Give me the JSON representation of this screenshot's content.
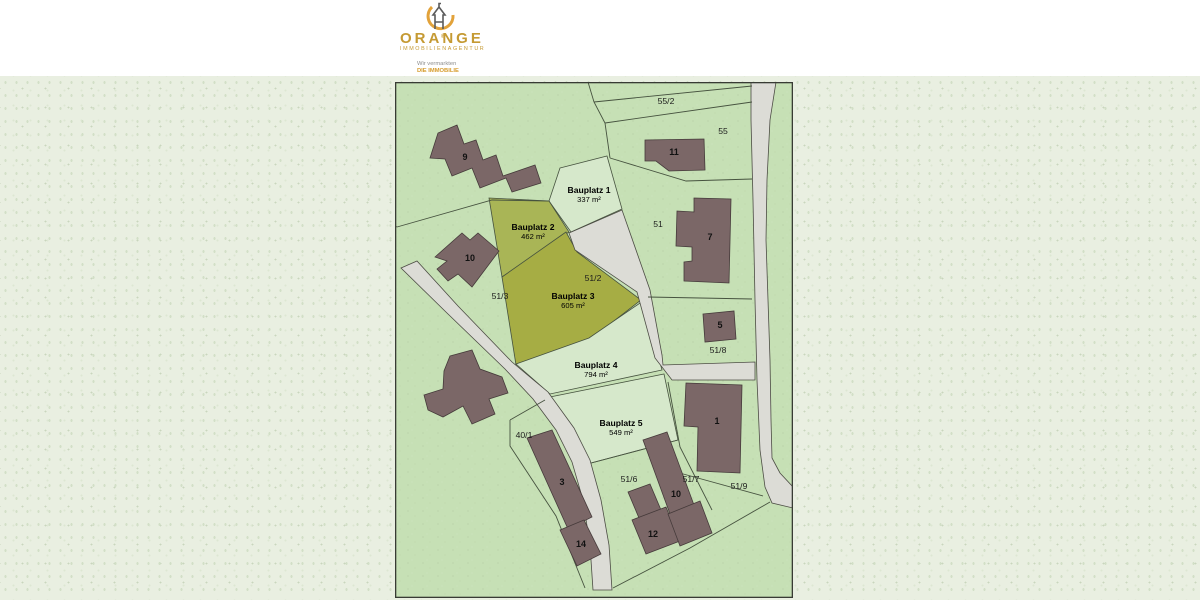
{
  "logo": {
    "brand": "ORANGE",
    "registered": "®",
    "subtitle": "IMMOBILIENAGENTUR",
    "tagline_line1": "Wir vermarkten",
    "tagline_line2": "DIE IMMOBILIE",
    "brand_color": "#c59a33",
    "swoosh_color": "#e2a23a"
  },
  "map": {
    "colors": {
      "base_green": "#c6e0b5",
      "plot_green": "#d6e8cb",
      "olive_plot2": "#a9b556",
      "olive_plot3": "#a6ad44",
      "road_fill": "#dcdcd6",
      "road_stroke": "#4c4c44",
      "line_stroke": "#46523f",
      "building_fill": "#7b6767",
      "building_stroke": "#453a3a",
      "border": "#383b34"
    },
    "frame": {
      "x": 395,
      "y": 82,
      "w": 398,
      "h": 516
    },
    "plots": [
      {
        "name": "parcel-bauplatz-1",
        "fill": "plot_green",
        "points": "560,168 607,156 622,209 571,232 549,201"
      },
      {
        "name": "parcel-bauplatz-2",
        "fill": "olive_plot2",
        "points": "489,198 549,201 569,232 502,277"
      },
      {
        "name": "parcel-bauplatz-3",
        "fill": "olive_plot3",
        "points": "502,277 566,232 577,252 641,300 588,341 516,365"
      },
      {
        "name": "parcel-bauplatz-4",
        "fill": "plot_green",
        "points": "516,364 589,338 643,301 662,370 550,394"
      },
      {
        "name": "parcel-bauplatz-5",
        "fill": "plot_green",
        "points": "545,398 664,374 678,440 591,463"
      }
    ],
    "roads": [
      {
        "name": "road-right",
        "points": "751,82 776,82 770,120 767,180 766,240 768,300 770,360 771,420 772,458 780,473 793,487 793,508 772,503 765,487 760,450 757,380 755,300 753,200 751,120"
      },
      {
        "name": "road-left",
        "points": "401,268 417,261 458,306 512,362 548,392 574,428 590,460 601,500 609,545 612,590 593,590 590,545 583,500 572,462 556,430 533,399 505,369 448,314"
      },
      {
        "name": "access-path",
        "points": "569,233 622,210 650,290 662,355 663,365 755,362 755,380 672,380 655,358 637,292 575,250"
      }
    ],
    "boundary_lines": [
      {
        "name": "line-outside-tick",
        "points": "384,221 397,227"
      },
      {
        "name": "line-parcel9-south",
        "points": "397,227 492,200 549,201"
      },
      {
        "name": "line-55-west",
        "points": "588,82 594,102 605,123 610,158"
      },
      {
        "name": "line-55-2-north",
        "points": "594,102 752,86"
      },
      {
        "name": "line-55-2-south",
        "points": "605,123 752,102"
      },
      {
        "name": "line-55-south",
        "points": "610,158 686,181 752,179"
      },
      {
        "name": "line-51-8-north",
        "points": "648,297 752,299"
      },
      {
        "name": "line-parcel1-west",
        "points": "668,382 680,447 712,510"
      },
      {
        "name": "line-51-9-south",
        "points": "676,472 763,496"
      },
      {
        "name": "line-bottom-long",
        "points": "613,588 690,548 770,502"
      },
      {
        "name": "line-bauplatz5-south",
        "points": "591,463 678,440"
      },
      {
        "name": "line-40-1-east",
        "points": "510,420 510,446 556,516 585,588"
      },
      {
        "name": "line-40-1-north",
        "points": "510,420 545,400"
      }
    ],
    "buildings": [
      {
        "name": "building-9",
        "label": "9",
        "lx": 465,
        "ly": 160,
        "points": "430,158 438,133 457,125 464,144 476,140 483,160 496,155 503,176 535,165 541,183 512,192 506,178 480,188 472,168 452,176 445,159"
      },
      {
        "name": "building-10",
        "label": "10",
        "lx": 470,
        "ly": 261,
        "points": "435,257 462,233 470,240 478,233 499,251 472,287 458,274 448,281 437,269 447,261"
      },
      {
        "name": "building-11",
        "label": "11",
        "lx": 674,
        "ly": 155,
        "points": "645,140 704,139 705,170 669,171 656,161 645,161"
      },
      {
        "name": "building-7",
        "label": "7",
        "lx": 710,
        "ly": 240,
        "points": "694,198 731,199 729,283 684,281 684,262 692,261 692,247 676,246 677,211 694,212"
      },
      {
        "name": "building-5",
        "label": "5",
        "lx": 720,
        "ly": 328,
        "points": "703,314 734,311 736,339 705,342"
      },
      {
        "name": "farm-building",
        "label": "",
        "lx": 0,
        "ly": 0,
        "points": "450,356 472,350 480,369 502,377 508,393 489,399 495,414 472,424 463,406 443,417 428,410 424,395 443,389 444,371"
      },
      {
        "name": "building-1",
        "label": "1",
        "lx": 717,
        "ly": 424,
        "points": "686,383 742,385 740,473 697,471 698,427 684,426"
      },
      {
        "name": "building-3",
        "label": "3",
        "lx": 562,
        "ly": 485,
        "points": "527,438 552,430 592,517 568,529"
      },
      {
        "name": "building-14",
        "label": "14",
        "lx": 581,
        "ly": 547,
        "points": "560,530 584,520 601,554 577,566"
      },
      {
        "name": "building-12a",
        "label": "",
        "lx": 0,
        "ly": 0,
        "points": "628,492 650,484 661,510 639,518"
      },
      {
        "name": "building-12",
        "label": "12",
        "lx": 653,
        "ly": 537,
        "points": "632,520 666,507 680,541 646,554"
      },
      {
        "name": "building-10b",
        "label": "10",
        "lx": 676,
        "ly": 497,
        "points": "643,440 667,432 694,505 670,514"
      },
      {
        "name": "building-10c",
        "label": "",
        "lx": 0,
        "ly": 0,
        "points": "668,514 700,501 712,533 680,546"
      }
    ],
    "parcel_labels": [
      {
        "text": "55/2",
        "x": 666,
        "y": 104
      },
      {
        "text": "55",
        "x": 723,
        "y": 134
      },
      {
        "text": "51",
        "x": 658,
        "y": 227
      },
      {
        "text": "51/3",
        "x": 500,
        "y": 299
      },
      {
        "text": "51/2",
        "x": 593,
        "y": 281
      },
      {
        "text": "51/8",
        "x": 718,
        "y": 353
      },
      {
        "text": "40/1",
        "x": 524,
        "y": 438
      },
      {
        "text": "51/6",
        "x": 629,
        "y": 482
      },
      {
        "text": "51/7",
        "x": 691,
        "y": 482
      },
      {
        "text": "51/9",
        "x": 739,
        "y": 489
      }
    ],
    "plot_labels": [
      {
        "name": "Bauplatz 1",
        "area": "337 m²",
        "x": 589,
        "y": 193
      },
      {
        "name": "Bauplatz 2",
        "area": "462 m²",
        "x": 533,
        "y": 230
      },
      {
        "name": "Bauplatz 3",
        "area": "605 m²",
        "x": 573,
        "y": 299
      },
      {
        "name": "Bauplatz 4",
        "area": "794 m²",
        "x": 596,
        "y": 368
      },
      {
        "name": "Bauplatz 5",
        "area": "549 m²",
        "x": 621,
        "y": 426
      }
    ]
  }
}
